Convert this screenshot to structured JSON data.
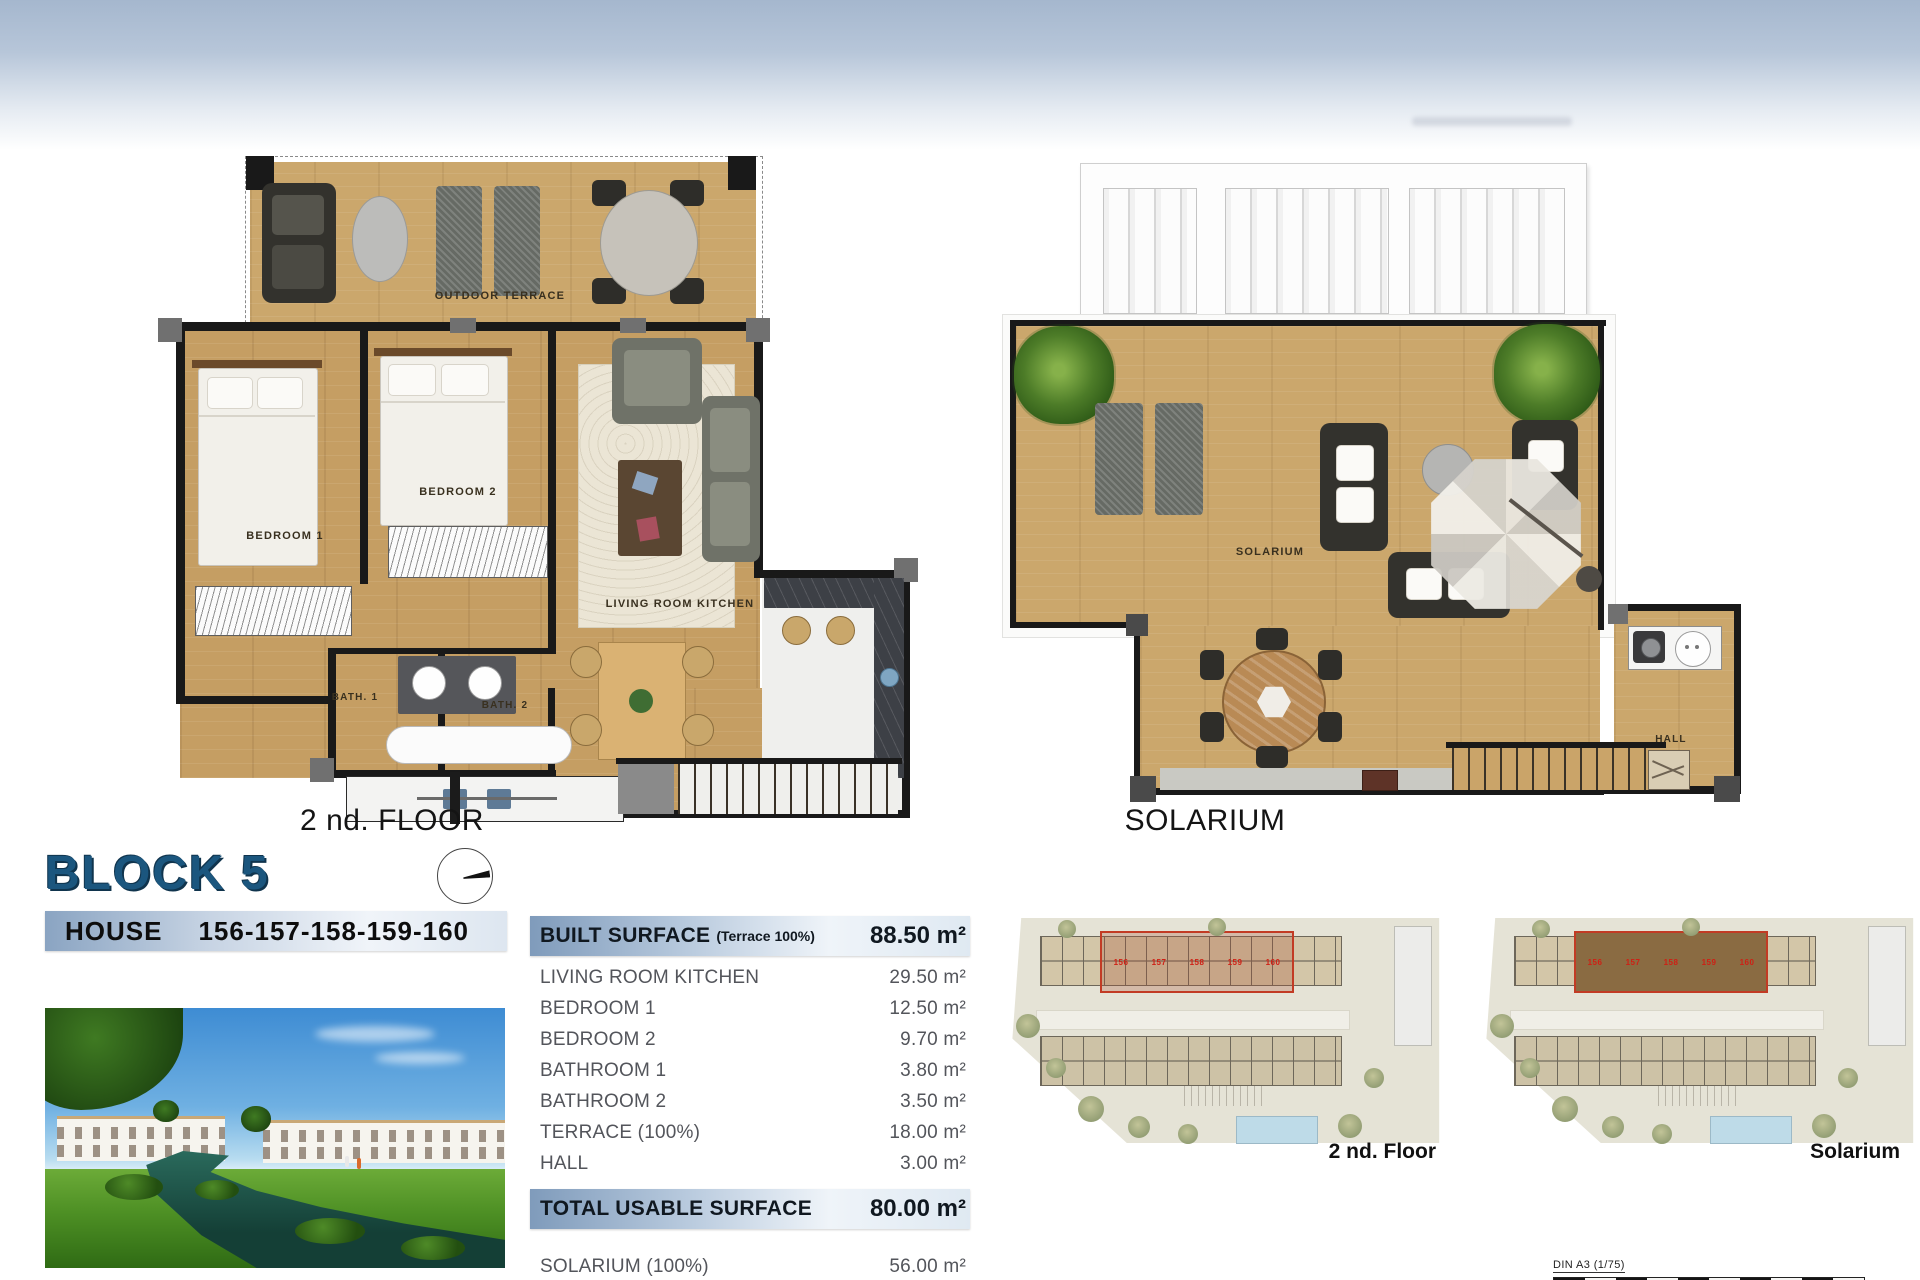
{
  "title": "BLOCK 5",
  "house": {
    "label": "HOUSE",
    "numbers": "156-157-158-159-160"
  },
  "plans": {
    "floor2": {
      "caption": "2 nd. FLOOR",
      "terrace": "OUTDOOR TERRACE",
      "bedroom1": "BEDROOM 1",
      "bedroom2": "BEDROOM 2",
      "living": "LIVING ROOM KITCHEN",
      "bath1": "BATH. 1",
      "bath2": "BATH. 2"
    },
    "solarium": {
      "caption": "SOLARIUM",
      "solarium": "SOLARIUM",
      "hall": "HALL"
    }
  },
  "surface_table": {
    "built": {
      "label": "BUILT SURFACE",
      "note": "(Terrace 100%)",
      "value": "88.50 m²"
    },
    "rows": [
      {
        "label": "LIVING ROOM KITCHEN",
        "value": "29.50 m²"
      },
      {
        "label": "BEDROOM 1",
        "value": "12.50 m²"
      },
      {
        "label": "BEDROOM 2",
        "value": "9.70 m²"
      },
      {
        "label": "BATHROOM 1",
        "value": "3.80 m²"
      },
      {
        "label": "BATHROOM 2",
        "value": "3.50 m²"
      },
      {
        "label": "TERRACE (100%)",
        "value": "18.00 m²"
      },
      {
        "label": "HALL",
        "value": "3.00 m²"
      }
    ],
    "total": {
      "label": "TOTAL USABLE SURFACE",
      "value": "80.00 m²"
    },
    "extra": {
      "label": "SOLARIUM (100%)",
      "value": "56.00 m²"
    }
  },
  "site_plans": {
    "captions": [
      "2 nd. Floor",
      "Solarium"
    ],
    "unit_numbers": [
      "156",
      "157",
      "158",
      "159",
      "160"
    ]
  },
  "scale_bar": {
    "label": "DIN A3 (1/75)",
    "ticks": [
      "0",
      "1",
      "2",
      "3",
      "4",
      "5"
    ]
  },
  "colors": {
    "accent_blue": "#1b567e",
    "band_steel": "#7f9bbb",
    "wood": "#c59e63",
    "highlight_red": "#c23b24"
  }
}
